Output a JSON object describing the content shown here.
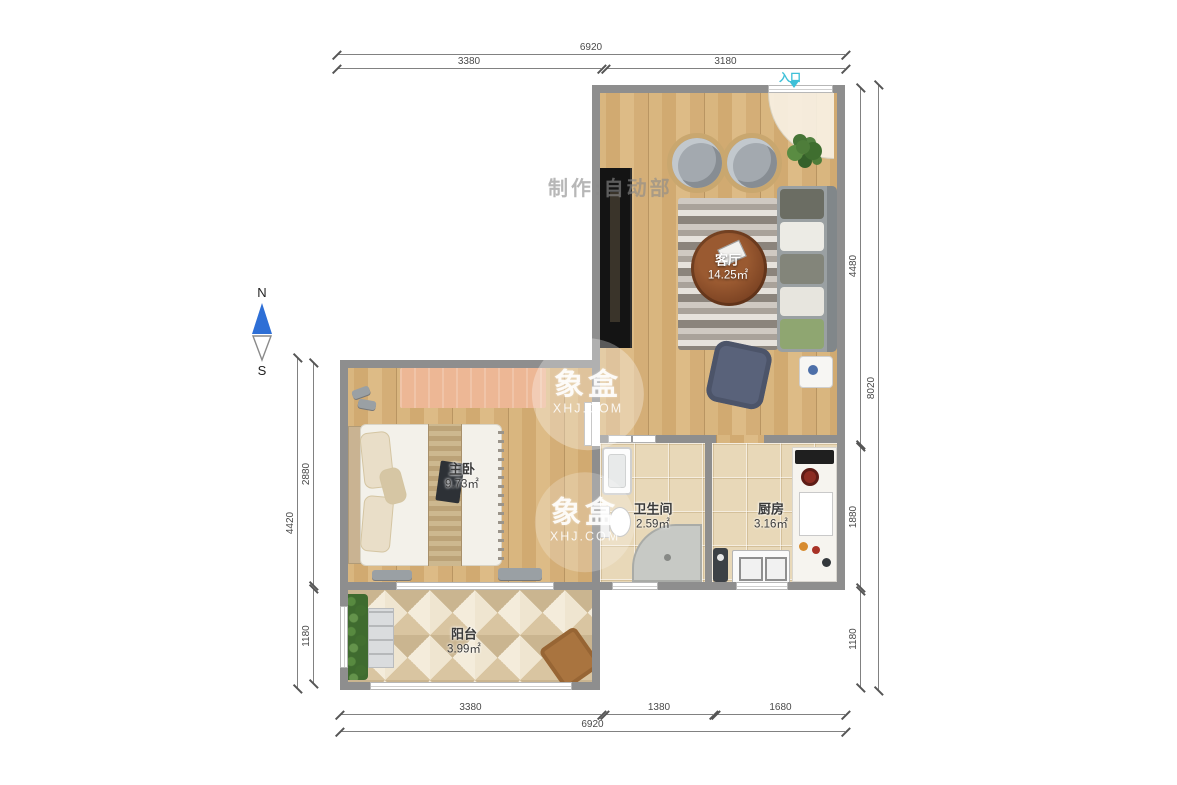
{
  "maker_watermark": "制作:自动部",
  "entrance": {
    "label": "入口"
  },
  "compass": {
    "north": "N",
    "south": "S"
  },
  "brand_watermark": {
    "name": "象盒",
    "site": "XHJ.COM"
  },
  "rooms": [
    {
      "name": "客厅",
      "area": "14.25㎡"
    },
    {
      "name": "主卧",
      "area": "9.73㎡"
    },
    {
      "name": "卫生间",
      "area": "2.59㎡"
    },
    {
      "name": "厨房",
      "area": "3.16㎡"
    },
    {
      "name": "阳台",
      "area": "3.99㎡"
    }
  ],
  "dimensions": {
    "top": {
      "overall": "6920",
      "segments": [
        "3380",
        "3180"
      ]
    },
    "bottom": {
      "overall": "6920",
      "segments": [
        "3380",
        "1380",
        "1680"
      ]
    },
    "left": {
      "overall": "4420",
      "segments": [
        "2880",
        "1180"
      ]
    },
    "right": {
      "overall": "8020",
      "segments": [
        "4480",
        "1880",
        "1180"
      ]
    }
  },
  "colors": {
    "wall": "#8e8e8e",
    "wood": "#d8b47c",
    "tile": "#e8d8b8",
    "entrance_accent": "#3ec0d8",
    "north_arrow": "#2e6fd6",
    "label_text": "#3a3a3a",
    "dim_text": "#4a4a4a"
  }
}
